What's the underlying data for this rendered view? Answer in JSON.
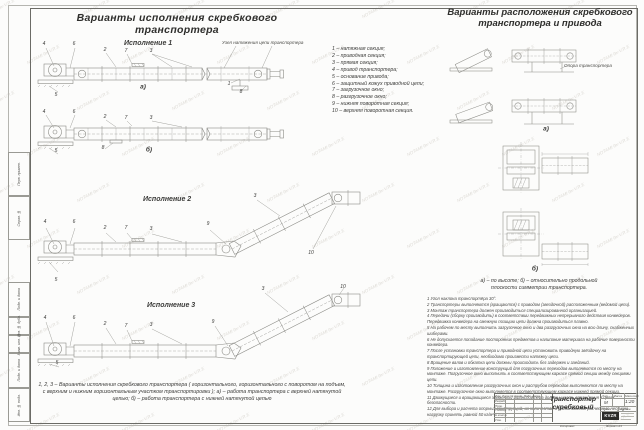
{
  "watermark": "NOTAMI-9x-V.R.E",
  "titles": {
    "left": "Варианты исполнения скребкового транспортера",
    "right_line1": "Варианты расположения скребкового",
    "right_line2": "транспортера и привода"
  },
  "sections": {
    "v1": "Исполнение 1",
    "v2": "Исполнение 2",
    "v3": "Исполнение 3",
    "tension_note": "Узел натяжения цепи транспортера"
  },
  "parts_list": [
    "1 –  натяжная секция;",
    "2 –  приводная секция;",
    "3 –  прямая секция;",
    "4 –  привод транспортера;",
    "5 –  основание привода;",
    "6 –  защитный кожух приводной цепи;",
    "7 –  загрузочное окно;",
    "8 –  разгрузочное окно;",
    "9 –  нижняя поворотная секция;",
    "10 –  верхняя поворотная секция."
  ],
  "callouts": [
    {
      "t": "4",
      "x": 44,
      "y": 44
    },
    {
      "t": "6",
      "x": 74,
      "y": 44
    },
    {
      "t": "2",
      "x": 105,
      "y": 50
    },
    {
      "t": "7",
      "x": 126,
      "y": 51
    },
    {
      "t": "3",
      "x": 151,
      "y": 51
    },
    {
      "t": "5",
      "x": 56,
      "y": 95
    },
    {
      "t": "1",
      "x": 229,
      "y": 84
    },
    {
      "t": "8",
      "x": 241,
      "y": 92
    },
    {
      "t": "а)",
      "x": 143,
      "y": 87,
      "big": true
    },
    {
      "t": "4",
      "x": 44,
      "y": 112
    },
    {
      "t": "6",
      "x": 74,
      "y": 112
    },
    {
      "t": "2",
      "x": 105,
      "y": 117
    },
    {
      "t": "7",
      "x": 126,
      "y": 118
    },
    {
      "t": "3",
      "x": 151,
      "y": 118
    },
    {
      "t": "5",
      "x": 56,
      "y": 151
    },
    {
      "t": "8",
      "x": 103,
      "y": 148
    },
    {
      "t": "б)",
      "x": 149,
      "y": 150,
      "big": true
    },
    {
      "t": "4",
      "x": 45,
      "y": 222
    },
    {
      "t": "6",
      "x": 74,
      "y": 222
    },
    {
      "t": "2",
      "x": 105,
      "y": 228
    },
    {
      "t": "7",
      "x": 126,
      "y": 228
    },
    {
      "t": "3",
      "x": 151,
      "y": 229
    },
    {
      "t": "9",
      "x": 208,
      "y": 224
    },
    {
      "t": "3",
      "x": 255,
      "y": 196
    },
    {
      "t": "10",
      "x": 311,
      "y": 253
    },
    {
      "t": "5",
      "x": 56,
      "y": 280
    },
    {
      "t": "4",
      "x": 45,
      "y": 318
    },
    {
      "t": "6",
      "x": 74,
      "y": 318
    },
    {
      "t": "2",
      "x": 105,
      "y": 324
    },
    {
      "t": "7",
      "x": 126,
      "y": 326
    },
    {
      "t": "3",
      "x": 151,
      "y": 325
    },
    {
      "t": "9",
      "x": 213,
      "y": 322
    },
    {
      "t": "3",
      "x": 263,
      "y": 289
    },
    {
      "t": "10",
      "x": 343,
      "y": 287
    },
    {
      "t": "5",
      "x": 57,
      "y": 363
    },
    {
      "t": "а)",
      "x": 546,
      "y": 129,
      "big": true
    },
    {
      "t": "б)",
      "x": 535,
      "y": 269,
      "big": true
    }
  ],
  "left_caption": "1, 2, 3 –  Варианты исполнения скребкового транспортера ( горизонтального,  горизонтального с поворотом на подъем,  с верхним и нижним горизонтальным участком транспортировки );  а) – работа транспортера с верхней натянутой цепью;  б) –  работа транспортера с нижней натянутой цепью",
  "right_col": {
    "support_label": "Опора транспортера",
    "caption_line1": "а) –  по высоте;  б) –  относительно продольной",
    "caption_line2": "плоскости симметрии транспортера.",
    "notes": [
      "1  Угол наклона транспортёра  30°.",
      "2  Транспортеры выполняются (вращаются) с приводом (звездочкой) расположенным (ведомой цепи).",
      "3  Монтаж транспортера должен производиться специализированной организацией.",
      "4  Передачи (сборку производить) в соответствии передвижных непрерывного действия конвейеров. Передвижка конвейера на смежную позицию цепи должна производиться плавно.",
      "5  На рабочем по месту выполнить загрузочное окно и два разгрузочных окна на всю длину, снабженных шиберами.",
      "6  Не допускается попадание посторонних предметов и налипание материала на рабочие поверхности конвейера.",
      "7  После установки транспортера и приводной цепи установить приводную звёздочку на транспортирующей цепи, необходимо произвести натяжку цепи.",
      "8  Вращение валов и обкатка цепи должны происходить без задержек и заеданий.",
      "9  Положение и изготовление конструкций для погрузочных переходов выполняются по месту на монтаже. Погрузочное окно выполнить в соответствующем каркасе прямой секции между секциями цепи.",
      "10  Толщина и изготовление разгрузочных окон и раструбов переходов выполняются по месту на монтаже. Разгрузочное окно выполняется в соответствующем каркасе нижней прямой секции.",
      "11  Движущиеся и вращающиеся элементы транспортера должны иметь ограждения в целях безопасности.",
      "12  Для выбора и расчета опорных конструкций, их количества и расположения расчетную несущую нагрузку принять равной 50 кг/м²."
    ]
  },
  "frame_labels": [
    "Перв. примен.",
    "Справ. №",
    "Подп. и дата",
    "Инв. № дубл.",
    "Взам. инв. №",
    "Подп. и дата",
    "Инв. № подл."
  ],
  "titleblock": {
    "doc_title": "Транспортер скребковый",
    "header_row": "Изм.  Лист  № докум.   Подп.  Дата",
    "staff_rows": [
      "Разраб.",
      "Пров.",
      "Т.контр.",
      "Н.контр.",
      "Утв."
    ],
    "lit_header": "Лит.",
    "mass_header": "Масса",
    "scale_header": "Масштаб",
    "lit_value": "М",
    "scale_value": "1:20",
    "sheet_label": "Лист",
    "sheets_label": "Листов",
    "logo": "KVZR",
    "copied_label": "Копировал",
    "format_label": "Формат А3"
  }
}
